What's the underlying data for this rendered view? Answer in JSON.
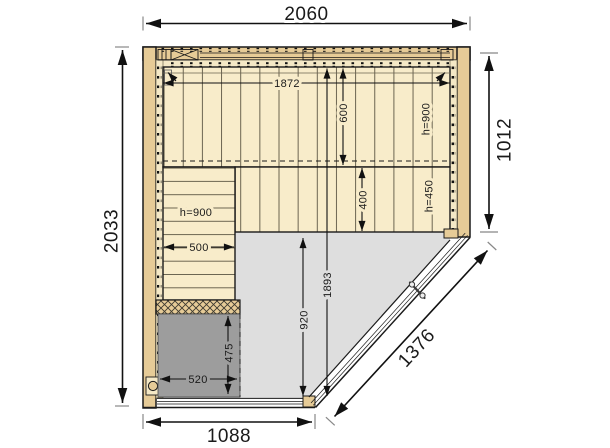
{
  "plan": {
    "type": "sauna-floor-plan",
    "dims": {
      "overall_width": "2060",
      "overall_depth": "2033",
      "right_wall_depth": "1012",
      "front_width": "1088",
      "door_wall_length": "1376",
      "interior_width": "1872",
      "interior_depth": "1893",
      "top_bench_depth": "600",
      "top_bench_height": "h=900",
      "mid_bench_depth": "400",
      "mid_bench_height": "h=450",
      "left_bench_width": "500",
      "left_bench_height": "h=900",
      "floor_clear_depth": "920",
      "heater_width": "520",
      "heater_depth": "475"
    },
    "colors": {
      "wood": "#e6cb97",
      "lining": "#f4e8c6",
      "bench": "#f8ecca",
      "floor": "#dedede",
      "heater": "#9d9d9d",
      "outline": "#1a1a1a"
    }
  }
}
